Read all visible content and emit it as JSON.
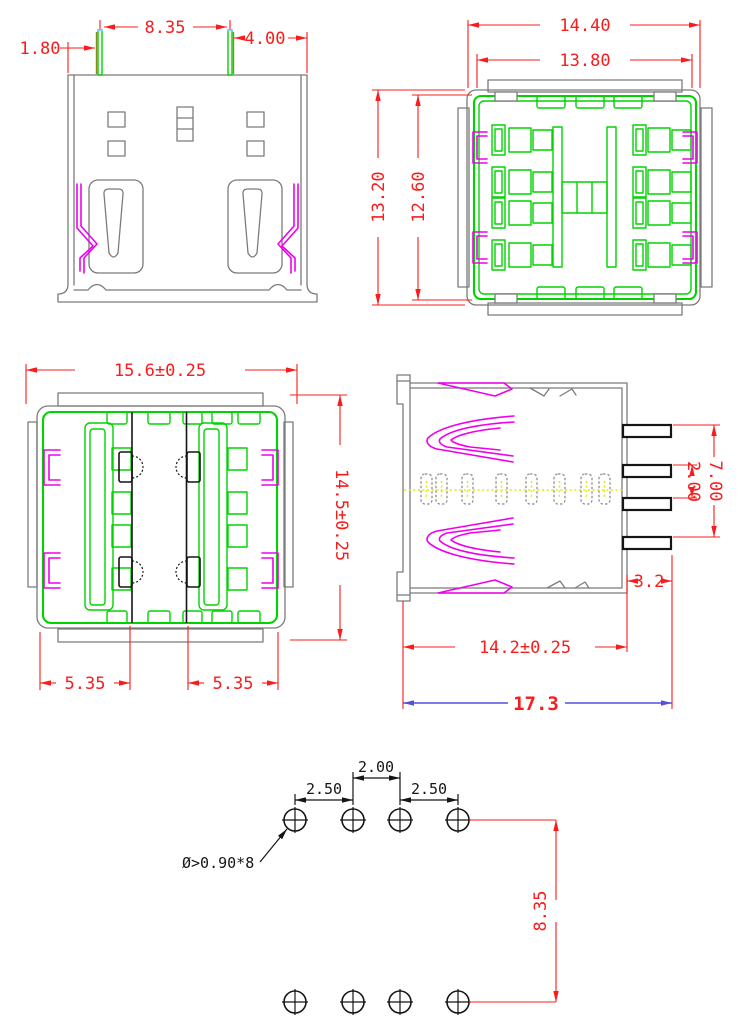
{
  "drawing": {
    "kind": "connector engineering drawing",
    "views": {
      "front": {
        "dims": {
          "pin_left_offset": "1.80",
          "pin_span": "8.35",
          "pin_right_offset": "4.00"
        }
      },
      "top": {
        "dims": {
          "outer_width": "14.40",
          "body_width": "13.80",
          "outer_depth": "13.20",
          "body_depth": "12.60"
        }
      },
      "face": {
        "dims": {
          "overall_width": "15.6±0.25",
          "overall_height": "14.5±0.25",
          "port_left_width": "5.35",
          "port_right_width": "5.35"
        }
      },
      "side": {
        "dims": {
          "pin_group_span": "7.00",
          "pin_pitch": "2.00",
          "pin_length": "3.2",
          "body_depth": "14.2±0.25",
          "overall_depth": "17.3"
        }
      },
      "footprint": {
        "dims": {
          "col_pitch_left": "2.50",
          "col_pitch_center": "2.00",
          "col_pitch_right": "2.50",
          "row_pitch": "8.35",
          "hole_callout": "Ø>0.90*8"
        }
      }
    },
    "colors": {
      "dimension_red": "#f81c1c",
      "outline_gray": "#7b7b7b",
      "contact_green": "#00d400",
      "spring_magenta": "#ee00ee",
      "wire_yellow": "#e8e800",
      "overall_dim_blue": "#5050d8",
      "pin_black": "#151515"
    }
  }
}
